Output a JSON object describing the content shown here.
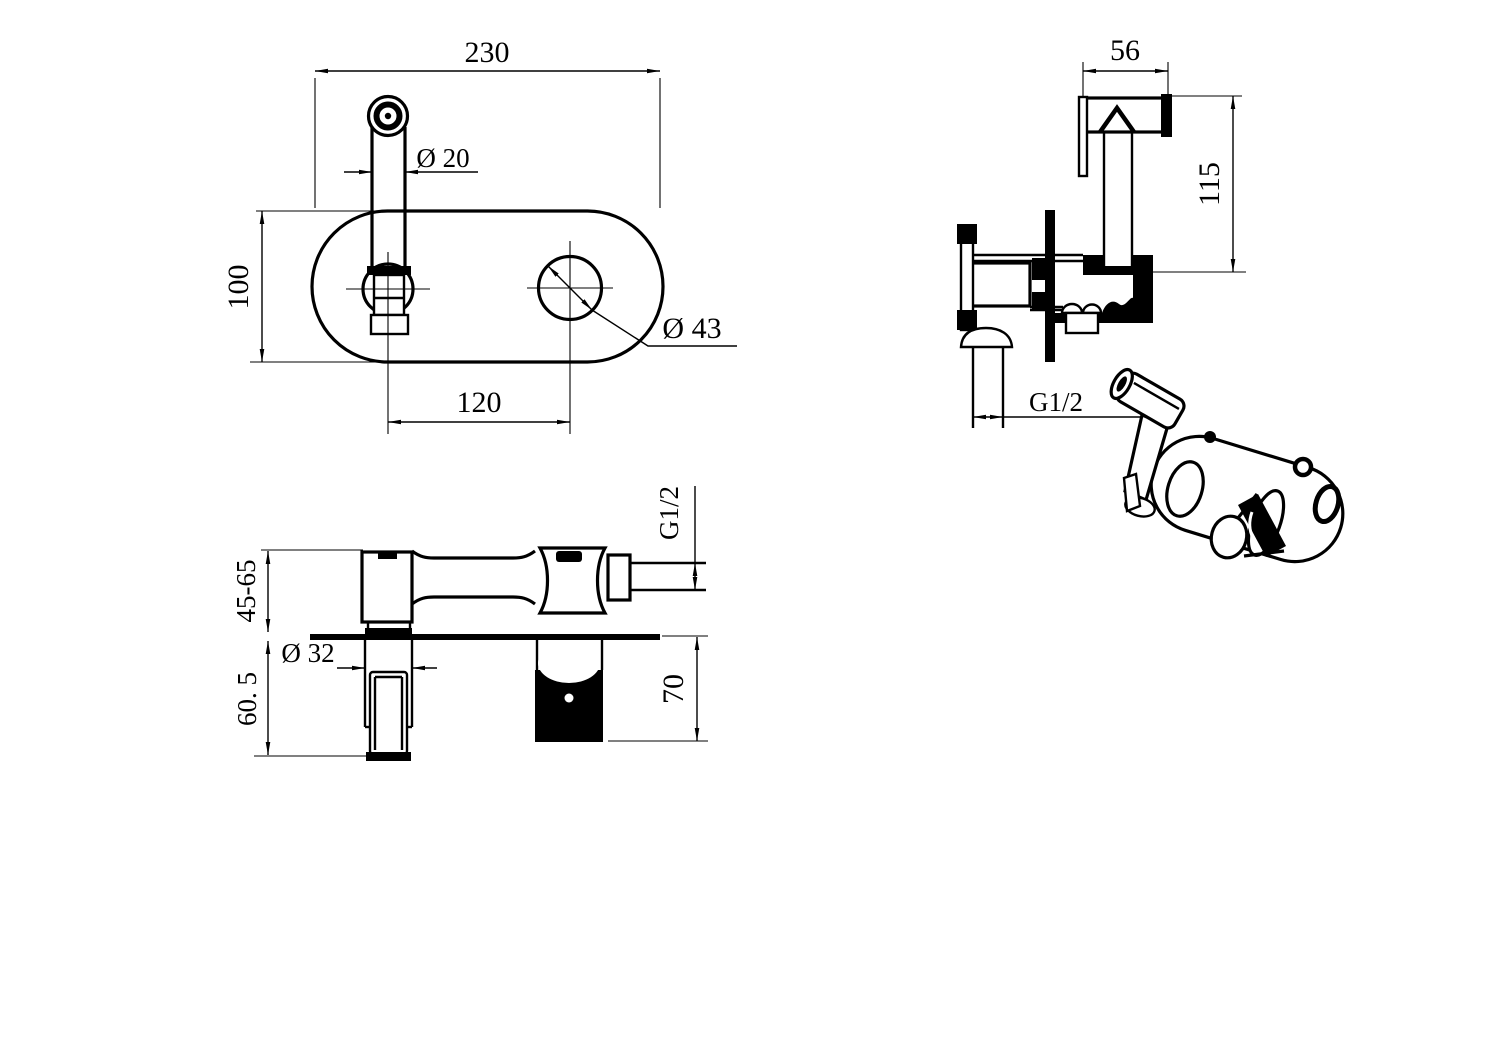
{
  "drawing": {
    "type": "technical-drawing",
    "subject": "wall-mounted bidet sprayer mixer",
    "line_color": "#000000",
    "background_color": "#ffffff",
    "views": {
      "front": {
        "label": "front-view",
        "dims": {
          "plate_width": "230",
          "plate_height": "100",
          "spout_diameter": "Ø 20",
          "hole_diameter": "Ø 43",
          "hole_spacing": "120"
        }
      },
      "side": {
        "label": "side-view",
        "dims": {
          "head_length": "56",
          "height": "115",
          "inlet_thread": "G1/2"
        }
      },
      "bottom": {
        "label": "section-view",
        "dims": {
          "depth_range": "45-65",
          "handle_depth": "60. 5",
          "trim_diameter": "Ø 32",
          "body_depth": "70",
          "outlet_thread": "G1/2"
        }
      },
      "perspective": {
        "label": "perspective-view"
      }
    }
  }
}
